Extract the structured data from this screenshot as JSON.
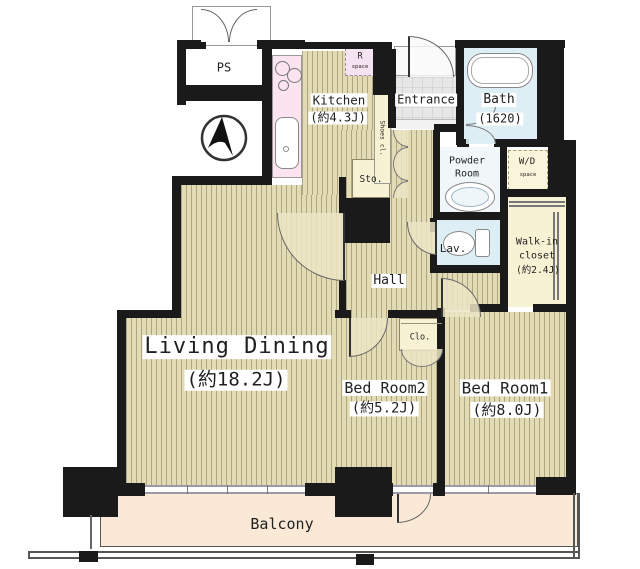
{
  "title": "Apartment floor plan",
  "icons": {
    "compass": "north-arrow"
  },
  "colors": {
    "wall": "#1a1a1a",
    "wood_floor": "#e2dbb4",
    "wood_stripe": "#827a58",
    "cream": "#f8f2d5",
    "kitchen_counter_pink": "#fbe3ef",
    "r_space_pink": "#f6e3f2",
    "water_blue": "#ddeef4",
    "entrance_gray": "#e7e7e7",
    "balcony_peach": "#fbe9d8"
  },
  "rooms": {
    "ps": {
      "label": "PS"
    },
    "kitchen": {
      "label": "Kitchen",
      "area": "(約4.3J)"
    },
    "refrigerator_space": {
      "label": "R",
      "sublabel": "space"
    },
    "shoes_closet": {
      "label": "Shoes cl."
    },
    "entrance": {
      "label": "Entrance"
    },
    "bath": {
      "label": "Bath",
      "area": "(1620)"
    },
    "powder_room": {
      "line1": "Powder",
      "line2": "Room"
    },
    "washer_dryer_space": {
      "label": "W/D",
      "sublabel": "space"
    },
    "storage": {
      "label": "Sto."
    },
    "lavatory": {
      "label": "Lav."
    },
    "walk_in_closet": {
      "line1": "Walk-in",
      "line2": "closet",
      "area": "(約2.4J)"
    },
    "hall": {
      "label": "Hall"
    },
    "living_dining": {
      "label": "Living Dining",
      "area": "(約18.2J)"
    },
    "closet": {
      "label": "Clo."
    },
    "bedroom2": {
      "label": "Bed Room2",
      "area": "(約5.2J)"
    },
    "bedroom1": {
      "label": "Bed Room1",
      "area": "(約8.0J)"
    },
    "balcony": {
      "label": "Balcony"
    }
  }
}
